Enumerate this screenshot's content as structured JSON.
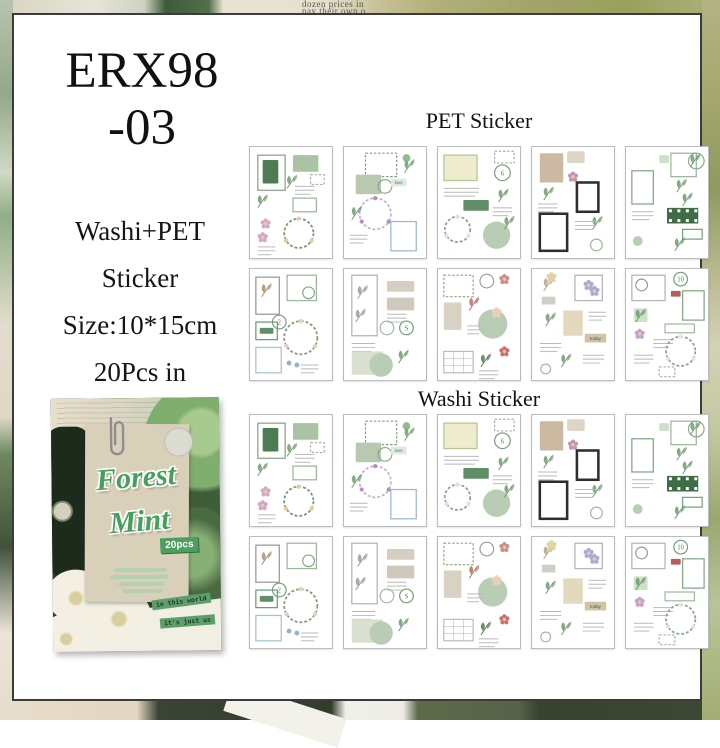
{
  "title": {
    "line1": "ERX98",
    "line2": "-03"
  },
  "info": {
    "lines": [
      "Washi+PET",
      "Sticker",
      "Size:10*15cm",
      "20Pcs in"
    ]
  },
  "sections": [
    {
      "id": "pet",
      "label": "PET Sticker"
    },
    {
      "id": "washi",
      "label": "Washi Sticker"
    }
  ],
  "background": {
    "newsprint_line1": "dozen prices in",
    "newsprint_line2": "pay their own o"
  },
  "cover": {
    "title_line1": "Forest",
    "title_line2": "Mint",
    "count_badge": "20pcs",
    "tag1": "in this world",
    "tag2": "it's just us"
  },
  "colors": {
    "panel_border": "#3b3b3b",
    "accent_green": "#4f9e5f",
    "sage_fill": "#b8cdb4",
    "leaf_green": "#6f9a6f",
    "cover_bg": "#2e3d2c",
    "paper_beige": "#d9d0ba"
  },
  "grid": {
    "cols": 5,
    "rows_per_section": 2,
    "col_x": [
      235,
      329,
      423,
      517,
      611
    ],
    "row_y_pet": [
      131,
      253
    ],
    "row_y_washi": [
      399,
      521
    ],
    "card_w": 84,
    "card_h": 113
  },
  "sheets": {
    "designs": [
      [
        {
          "t": "frame",
          "x": 8,
          "y": 8,
          "w": 28,
          "h": 36,
          "c": "#86a886"
        },
        {
          "t": "paper",
          "x": 13,
          "y": 13,
          "w": 16,
          "h": 24,
          "c": "#4d7b52"
        },
        {
          "t": "paper",
          "x": 44,
          "y": 8,
          "w": 26,
          "h": 17,
          "c": "#a9c3a4"
        },
        {
          "t": "stampframe",
          "x": 62,
          "y": 28,
          "w": 14,
          "h": 10,
          "c": "#9db89d"
        },
        {
          "t": "leaf",
          "x": 38,
          "y": 30
        },
        {
          "t": "lines",
          "x": 46,
          "y": 40,
          "w": 20
        },
        {
          "t": "frame",
          "x": 44,
          "y": 52,
          "w": 24,
          "h": 14,
          "c": "#9db89d"
        },
        {
          "t": "leaf",
          "x": 8,
          "y": 50
        },
        {
          "t": "flower",
          "x": 16,
          "y": 78,
          "c": "#d4a8cc"
        },
        {
          "t": "flower",
          "x": 13,
          "y": 92,
          "c": "#d4a8cc"
        },
        {
          "t": "wreath",
          "x": 50,
          "y": 88,
          "r": 15,
          "c": "#6f9a6f",
          "a": "#e8c9a0"
        },
        {
          "t": "lines",
          "x": 8,
          "y": 102,
          "w": 18
        }
      ],
      [
        {
          "t": "stampframe",
          "x": 22,
          "y": 6,
          "w": 32,
          "h": 24,
          "c": "#7d9d7d"
        },
        {
          "t": "circle",
          "x": 64,
          "y": 11,
          "r": 4,
          "c": "#8fbc8f"
        },
        {
          "t": "paper",
          "x": 12,
          "y": 28,
          "w": 26,
          "h": 20,
          "c": "#b9c9b0"
        },
        {
          "t": "ring",
          "x": 42,
          "y": 40,
          "r": 7,
          "c": "#86a886"
        },
        {
          "t": "tag",
          "x": 48,
          "y": 32,
          "w": 16,
          "h": 8,
          "c": "#dfeadf",
          "n": "love",
          "tc": "#4d7b52"
        },
        {
          "t": "leaf",
          "x": 62,
          "y": 14
        },
        {
          "t": "wreath",
          "x": 32,
          "y": 68,
          "r": 16,
          "c": "#c9aed3",
          "a": "#b58fc4"
        },
        {
          "t": "frame",
          "x": 48,
          "y": 76,
          "w": 26,
          "h": 30,
          "c": "#9fb8cf"
        },
        {
          "t": "lines",
          "x": 6,
          "y": 90,
          "w": 18
        },
        {
          "t": "leaf",
          "x": 8,
          "y": 62
        }
      ],
      [
        {
          "t": "paper",
          "x": 6,
          "y": 8,
          "w": 34,
          "h": 26,
          "c": "#eeebcf"
        },
        {
          "t": "frame",
          "x": 6,
          "y": 8,
          "w": 34,
          "h": 26,
          "c": "#b5c98f"
        },
        {
          "t": "stampframe",
          "x": 58,
          "y": 4,
          "w": 20,
          "h": 12,
          "c": "#9db89d"
        },
        {
          "t": "badge",
          "x": 66,
          "y": 26,
          "r": 8,
          "n": "6"
        },
        {
          "t": "lines",
          "x": 6,
          "y": 42,
          "w": 36
        },
        {
          "t": "tag",
          "x": 26,
          "y": 54,
          "w": 26,
          "h": 11,
          "c": "#5f8f66"
        },
        {
          "t": "leaf",
          "x": 62,
          "y": 44
        },
        {
          "t": "lines",
          "x": 56,
          "y": 62,
          "w": 20
        },
        {
          "t": "wreath",
          "x": 20,
          "y": 84,
          "r": 13,
          "c": "#86a886",
          "a": "#e0e0e0"
        },
        {
          "t": "circle",
          "x": 60,
          "y": 90,
          "r": 14,
          "c": "#b8cdb4"
        },
        {
          "t": "leaf",
          "x": 68,
          "y": 72
        }
      ],
      [
        {
          "t": "paper",
          "x": 8,
          "y": 6,
          "w": 24,
          "h": 30,
          "c": "#cbb9a2"
        },
        {
          "t": "paper",
          "x": 36,
          "y": 4,
          "w": 18,
          "h": 12,
          "c": "#ddd6c6"
        },
        {
          "t": "leaf",
          "x": 12,
          "y": 42
        },
        {
          "t": "flower",
          "x": 42,
          "y": 30,
          "c": "#c493bb"
        },
        {
          "t": "blackframe",
          "x": 46,
          "y": 36,
          "w": 22,
          "h": 30
        },
        {
          "t": "lines",
          "x": 6,
          "y": 58,
          "w": 20
        },
        {
          "t": "blackframe",
          "x": 8,
          "y": 68,
          "w": 28,
          "h": 38
        },
        {
          "t": "leaf",
          "x": 62,
          "y": 72
        },
        {
          "t": "lines",
          "x": 44,
          "y": 76,
          "w": 22
        },
        {
          "t": "ring",
          "x": 66,
          "y": 100,
          "r": 6,
          "c": "#9db89d"
        }
      ],
      [
        {
          "t": "frame",
          "x": 46,
          "y": 6,
          "w": 26,
          "h": 24,
          "c": "#9db89d"
        },
        {
          "t": "ring",
          "x": 72,
          "y": 14,
          "r": 8,
          "c": "#86a886"
        },
        {
          "t": "leaf",
          "x": 66,
          "y": 8
        },
        {
          "t": "frame",
          "x": 6,
          "y": 24,
          "w": 22,
          "h": 34,
          "c": "#86a886"
        },
        {
          "t": "paper",
          "x": 34,
          "y": 8,
          "w": 10,
          "h": 8,
          "c": "#cfe0c9"
        },
        {
          "t": "leaf",
          "x": 52,
          "y": 34
        },
        {
          "t": "leaf",
          "x": 58,
          "y": 48
        },
        {
          "t": "film",
          "x": 42,
          "y": 62,
          "w": 32,
          "h": 16
        },
        {
          "t": "banner",
          "x": 58,
          "y": 84,
          "w": 20,
          "h": 10,
          "c": "#6f9e76"
        },
        {
          "t": "lines",
          "x": 6,
          "y": 66,
          "w": 22
        },
        {
          "t": "leaf",
          "x": 50,
          "y": 94
        },
        {
          "t": "circle",
          "x": 12,
          "y": 96,
          "r": 5,
          "c": "#b8cdb4"
        }
      ],
      [
        {
          "t": "frame",
          "x": 6,
          "y": 8,
          "w": 24,
          "h": 38,
          "c": "#9a9a9a"
        },
        {
          "t": "leaf",
          "x": 12,
          "y": 16,
          "c": "#a98f6f"
        },
        {
          "t": "frame",
          "x": 38,
          "y": 6,
          "w": 30,
          "h": 26,
          "c": "#9db89d"
        },
        {
          "t": "ring",
          "x": 60,
          "y": 24,
          "r": 6,
          "c": "#86a886"
        },
        {
          "t": "badge",
          "x": 30,
          "y": 54,
          "r": 7,
          "n": "2"
        },
        {
          "t": "frame",
          "x": 6,
          "y": 54,
          "w": 22,
          "h": 18,
          "c": "#6f9e76"
        },
        {
          "t": "tag",
          "x": 10,
          "y": 60,
          "w": 14,
          "h": 6,
          "c": "#5f8f66"
        },
        {
          "t": "wreath",
          "x": 52,
          "y": 70,
          "r": 17,
          "c": "#8a9a7a",
          "a": "#e8cfc0"
        },
        {
          "t": "frame",
          "x": 6,
          "y": 80,
          "w": 26,
          "h": 26,
          "c": "#a9c3cf"
        },
        {
          "t": "drops",
          "x": 40,
          "y": 96
        },
        {
          "t": "lines",
          "x": 52,
          "y": 98,
          "w": 18
        }
      ],
      [
        {
          "t": "frame",
          "x": 8,
          "y": 6,
          "w": 26,
          "h": 62,
          "c": "#b5b5b5"
        },
        {
          "t": "leaf",
          "x": 14,
          "y": 18,
          "c": "#9a9a9a"
        },
        {
          "t": "leaf",
          "x": 12,
          "y": 42,
          "c": "#9a9a9a"
        },
        {
          "t": "paper",
          "x": 44,
          "y": 12,
          "w": 28,
          "h": 11,
          "c": "#d5cfc2"
        },
        {
          "t": "paper",
          "x": 44,
          "y": 29,
          "w": 28,
          "h": 13,
          "c": "#cfc9bc"
        },
        {
          "t": "lines",
          "x": 44,
          "y": 46,
          "w": 20
        },
        {
          "t": "ring",
          "x": 44,
          "y": 60,
          "r": 7,
          "c": "#9db89d"
        },
        {
          "t": "badge",
          "x": 64,
          "y": 60,
          "r": 7,
          "n": "S"
        },
        {
          "t": "lines",
          "x": 8,
          "y": 76,
          "w": 24
        },
        {
          "t": "paper",
          "x": 8,
          "y": 84,
          "w": 32,
          "h": 24,
          "c": "#d9e0cf"
        },
        {
          "t": "circle",
          "x": 38,
          "y": 98,
          "r": 12,
          "c": "#b8cdb4"
        },
        {
          "t": "leaf",
          "x": 56,
          "y": 84
        }
      ],
      [
        {
          "t": "stampframe",
          "x": 6,
          "y": 6,
          "w": 30,
          "h": 22,
          "c": "#86a886"
        },
        {
          "t": "ring",
          "x": 50,
          "y": 12,
          "r": 7,
          "c": "#9a9a9a"
        },
        {
          "t": "flower",
          "x": 68,
          "y": 10,
          "c": "#cc8f8f"
        },
        {
          "t": "paper",
          "x": 6,
          "y": 34,
          "w": 18,
          "h": 28,
          "c": "#d8d2c2"
        },
        {
          "t": "leaf",
          "x": 32,
          "y": 30,
          "c": "#b56f5e"
        },
        {
          "t": "circle",
          "x": 56,
          "y": 56,
          "r": 15,
          "c": "#b8cdb4"
        },
        {
          "t": "flower",
          "x": 60,
          "y": 44,
          "c": "#e8cfc0"
        },
        {
          "t": "lines",
          "x": 30,
          "y": 58,
          "w": 16
        },
        {
          "t": "grid",
          "x": 6,
          "y": 84,
          "w": 30,
          "h": 22
        },
        {
          "t": "leaf",
          "x": 44,
          "y": 88,
          "c": "#4d7b52"
        },
        {
          "t": "flower",
          "x": 68,
          "y": 84,
          "c": "#cc6f6f"
        },
        {
          "t": "lines",
          "x": 42,
          "y": 104,
          "w": 20
        }
      ],
      [
        {
          "t": "leaf",
          "x": 12,
          "y": 10,
          "c": "#b0a487"
        },
        {
          "t": "flower",
          "x": 20,
          "y": 8,
          "c": "#dfd3ae"
        },
        {
          "t": "paper",
          "x": 10,
          "y": 28,
          "w": 14,
          "h": 8,
          "c": "#cfcfc9"
        },
        {
          "t": "frame",
          "x": 44,
          "y": 6,
          "w": 28,
          "h": 26,
          "c": "#b5b5b5"
        },
        {
          "t": "flower",
          "x": 58,
          "y": 16,
          "c": "#b0a8d8"
        },
        {
          "t": "flower",
          "x": 64,
          "y": 22,
          "c": "#b0a8d8"
        },
        {
          "t": "paper",
          "x": 32,
          "y": 42,
          "w": 20,
          "h": 26,
          "c": "#e3d9bc"
        },
        {
          "t": "lines",
          "x": 58,
          "y": 44,
          "w": 18
        },
        {
          "t": "tag",
          "x": 54,
          "y": 66,
          "w": 22,
          "h": 9,
          "c": "#cfc4a6",
          "n": "today",
          "tc": "#5a523e"
        },
        {
          "t": "leaf",
          "x": 14,
          "y": 46
        },
        {
          "t": "lines",
          "x": 8,
          "y": 76,
          "w": 22
        },
        {
          "t": "leaf",
          "x": 30,
          "y": 88
        },
        {
          "t": "lines",
          "x": 52,
          "y": 88,
          "w": 22
        },
        {
          "t": "ring",
          "x": 14,
          "y": 102,
          "r": 5,
          "c": "#9db89d"
        }
      ],
      [
        {
          "t": "frame",
          "x": 6,
          "y": 6,
          "w": 34,
          "h": 26,
          "c": "#b5b5b5"
        },
        {
          "t": "ring",
          "x": 16,
          "y": 16,
          "r": 6,
          "c": "#9a9a9a"
        },
        {
          "t": "badge",
          "x": 56,
          "y": 10,
          "r": 7,
          "n": "10"
        },
        {
          "t": "tag",
          "x": 46,
          "y": 22,
          "w": 10,
          "h": 6,
          "c": "#b55e5e"
        },
        {
          "t": "frame",
          "x": 58,
          "y": 22,
          "w": 22,
          "h": 30,
          "c": "#86a886"
        },
        {
          "t": "paper",
          "x": 8,
          "y": 40,
          "w": 14,
          "h": 14,
          "c": "#cfe0c9"
        },
        {
          "t": "leaf",
          "x": 10,
          "y": 42
        },
        {
          "t": "banner",
          "x": 40,
          "y": 56,
          "w": 30,
          "h": 9,
          "c": "#9db89d"
        },
        {
          "t": "flower",
          "x": 14,
          "y": 66,
          "c": "#c9a0d3"
        },
        {
          "t": "lines",
          "x": 28,
          "y": 72,
          "w": 20
        },
        {
          "t": "wreath",
          "x": 56,
          "y": 84,
          "r": 15,
          "c": "#86a886",
          "a": "#dfe8df"
        },
        {
          "t": "lines",
          "x": 8,
          "y": 88,
          "w": 20
        },
        {
          "t": "stampframe",
          "x": 34,
          "y": 100,
          "w": 16,
          "h": 10,
          "c": "#9db89d"
        }
      ]
    ]
  }
}
